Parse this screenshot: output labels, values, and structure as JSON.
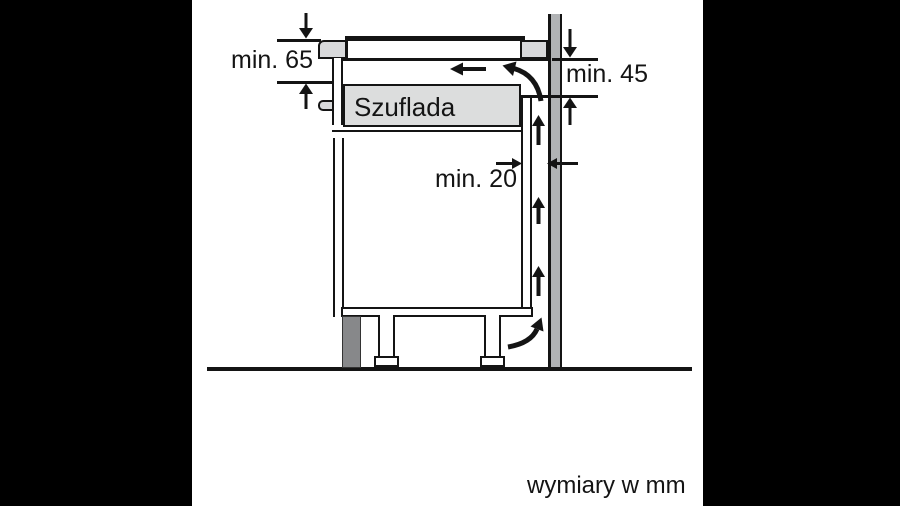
{
  "diagram": {
    "title": "appliance-installation-clearance-diagram",
    "labels": {
      "min65": "min. 65",
      "min45": "min. 45",
      "min20": "min. 20",
      "drawer": "Szuflada",
      "units": "wymiary w mm"
    },
    "colors": {
      "background": "#000000",
      "canvas": "#ffffff",
      "line": "#141414",
      "surface_light": "#d8d9db",
      "drawer_fill": "#dcdddd",
      "wall_fill": "#b1b3b5",
      "plinth_fill": "#87888a"
    }
  }
}
